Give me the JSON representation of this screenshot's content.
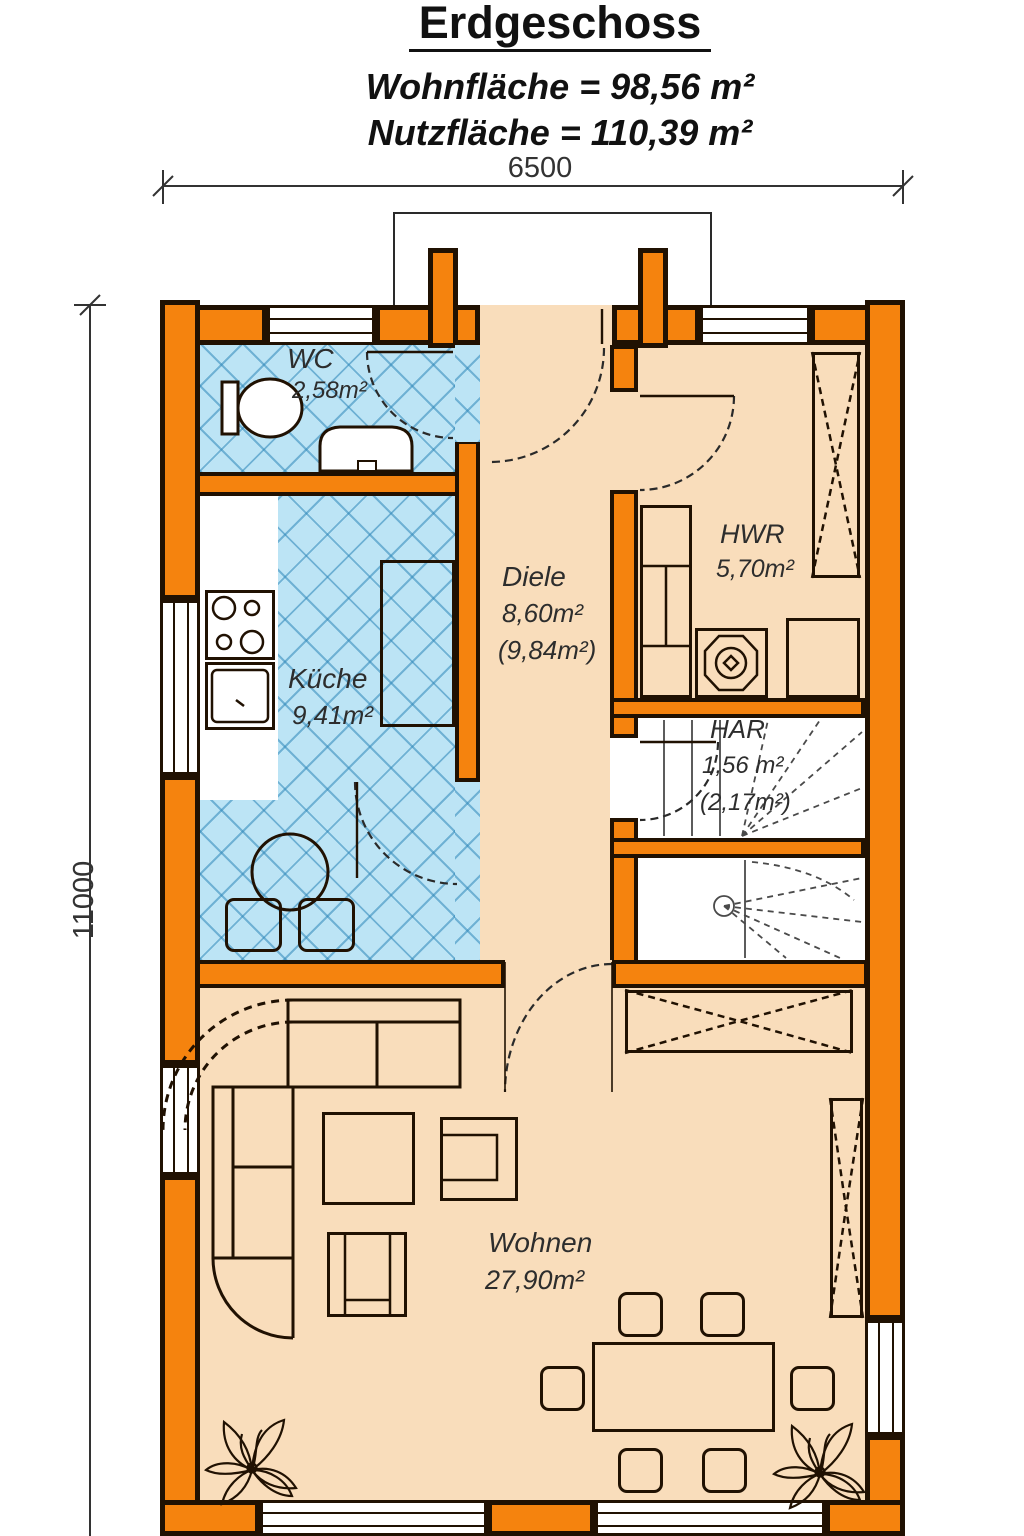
{
  "header": {
    "title": "Erdgeschoss",
    "living_area_line": "Wohnfläche = 98,56 m²",
    "usable_area_line": "Nutzfläche = 110,39 m²"
  },
  "dimensions": {
    "width_mm": "6500",
    "depth_mm": "11000"
  },
  "rooms": {
    "wc": {
      "name": "WC",
      "area": "2,58m²"
    },
    "kueche": {
      "name": "Küche",
      "area": "9,41m²"
    },
    "diele": {
      "name": "Diele",
      "area": "8,60m²",
      "area_alt": "(9,84m²)"
    },
    "hwr": {
      "name": "HWR",
      "area": "5,70m²"
    },
    "har": {
      "name": "HAR",
      "area": "1,56 m²",
      "area_alt": "(2,17m²)"
    },
    "wohnen": {
      "name": "Wohnen",
      "area": "27,90m²"
    }
  },
  "colors": {
    "wall_fill": "#F5830E",
    "wall_outline": "#201102",
    "floor": "#F9DDBB",
    "tile": "#BCE4F5",
    "tile_line": "#2F87B9"
  }
}
